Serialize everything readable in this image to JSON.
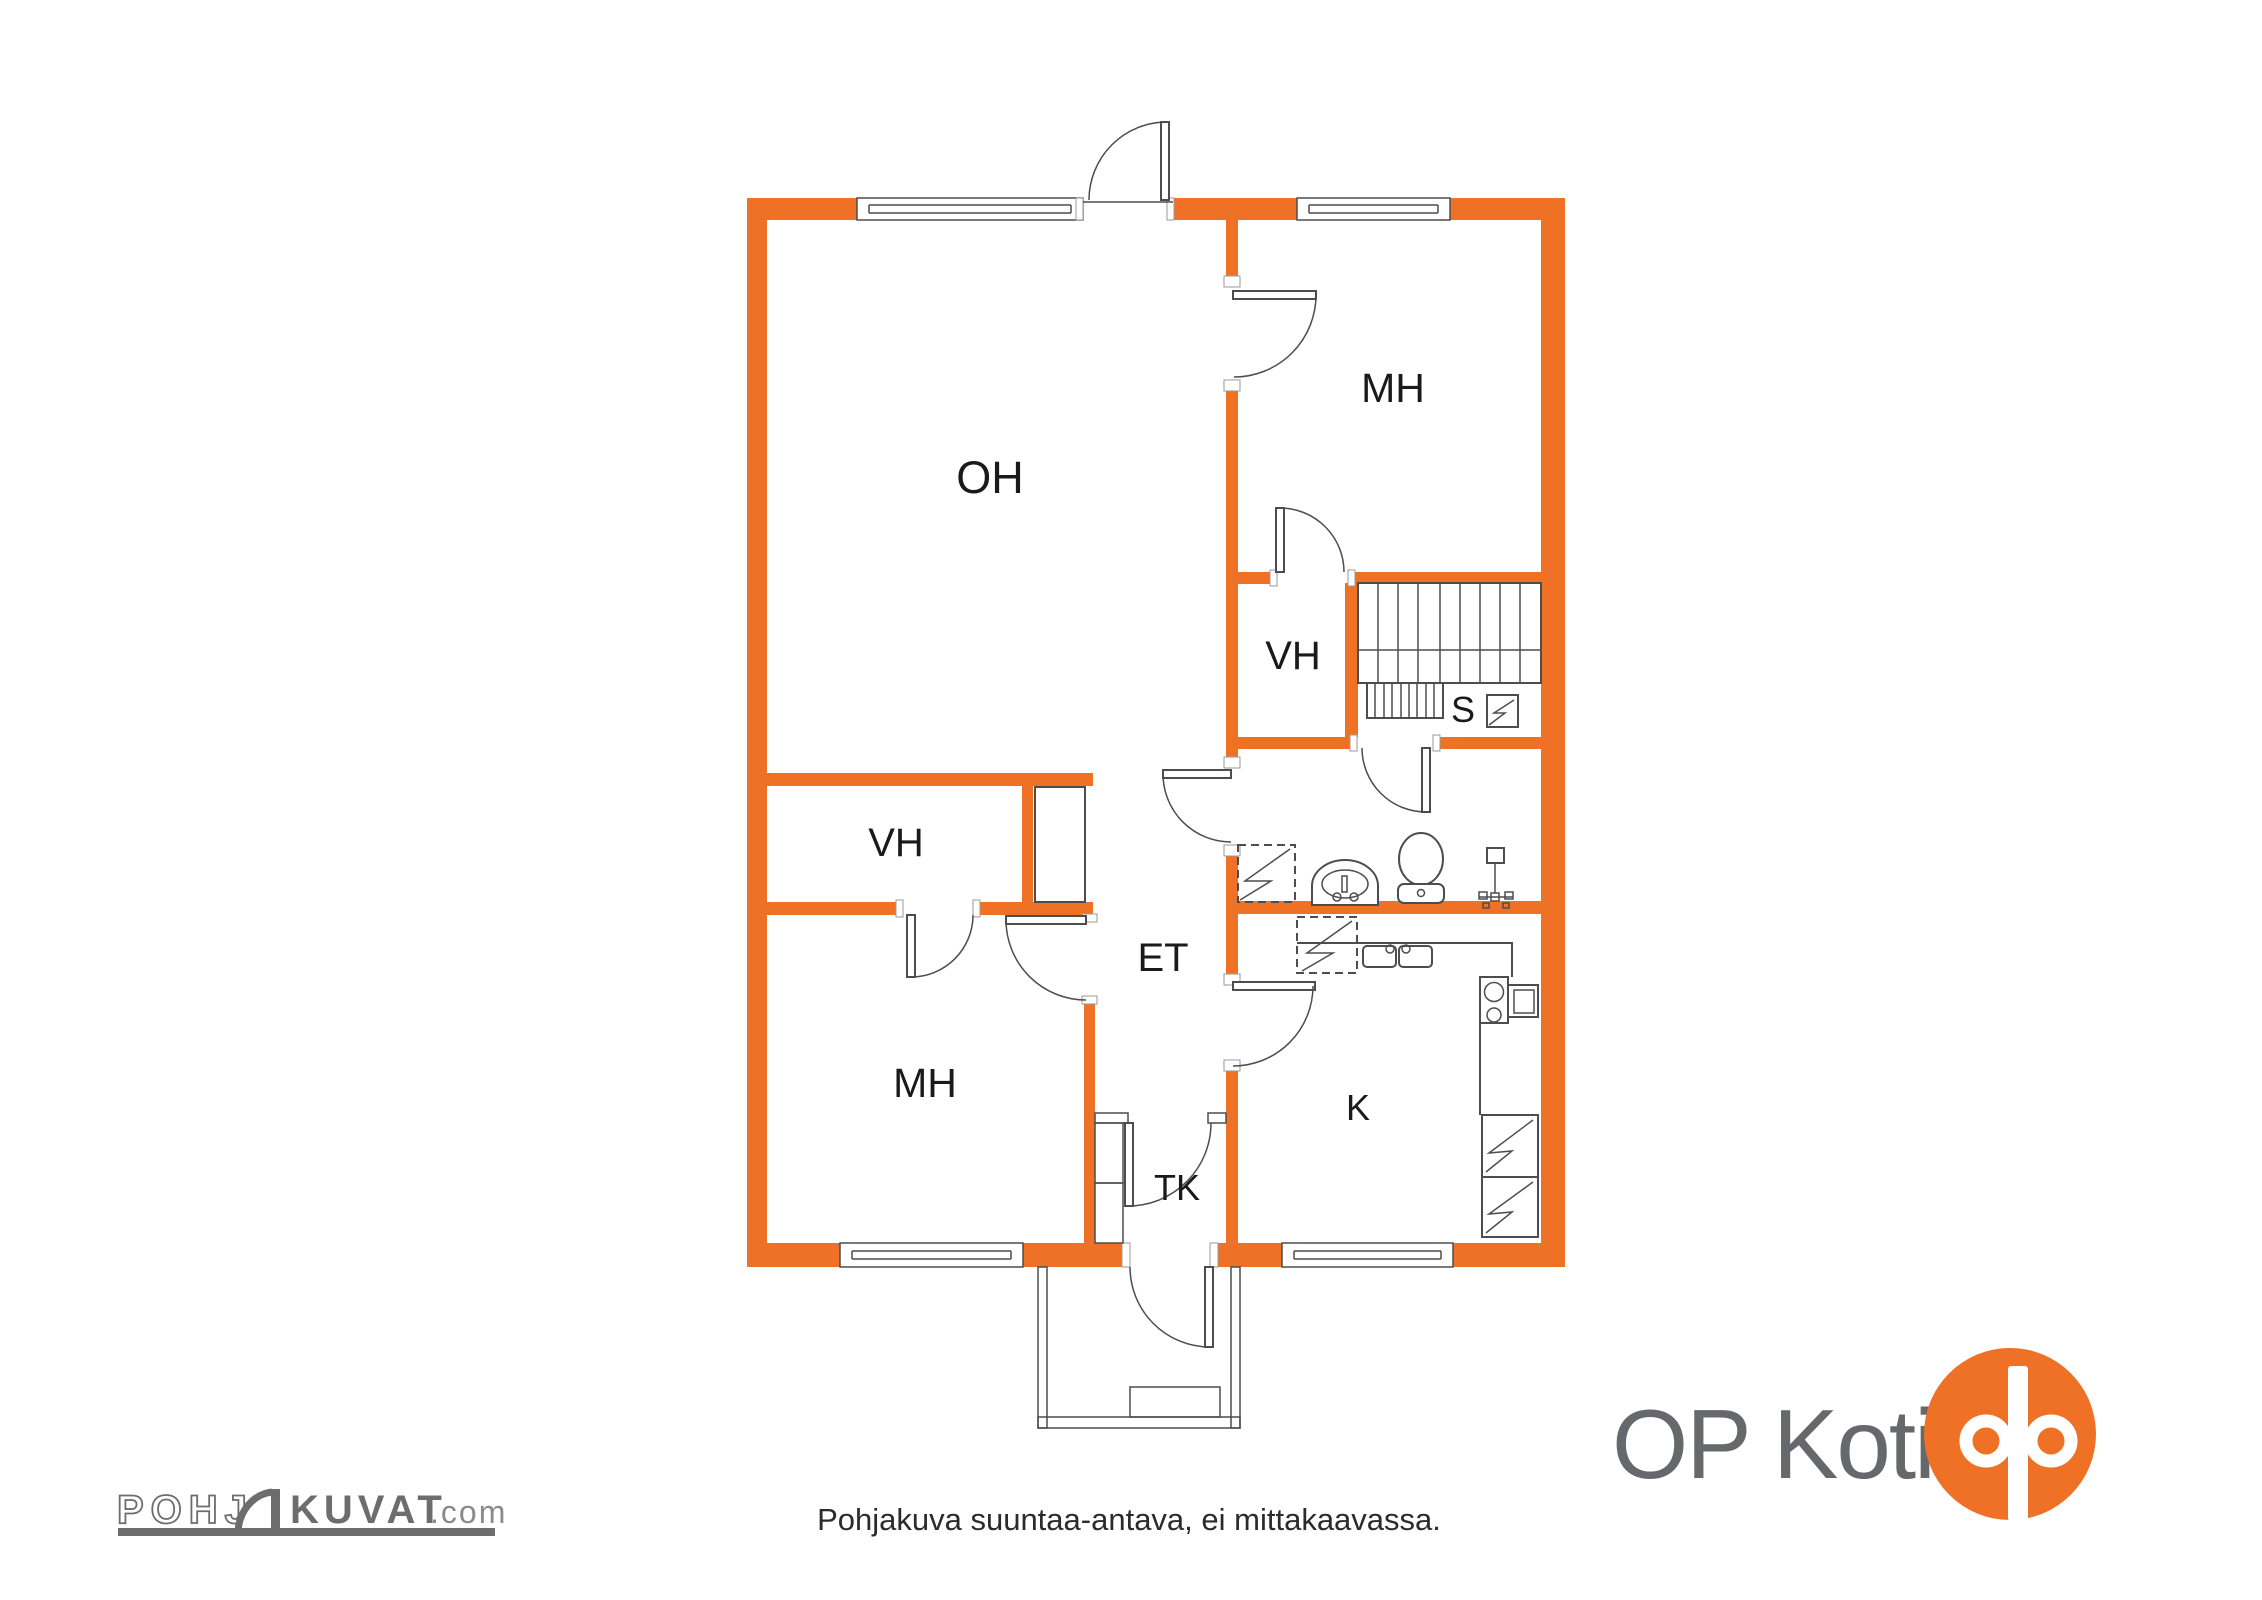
{
  "colors": {
    "wall": "#EE7125",
    "line": "#4D4D4F",
    "label": "#1A1A1A",
    "logogray": "#6D6D6D",
    "logograylight": "#8B8B8B",
    "optext": "#66686B",
    "disc": "#2B2B2B"
  },
  "labels": {
    "oh": "OH",
    "mh_top": "MH",
    "vh_right": "VH",
    "stairs_s": "S",
    "vh_left": "VH",
    "et": "ET",
    "mh_bottom": "MH",
    "tk": "TK",
    "k": "K"
  },
  "footer": {
    "disclaimer": "Pohjakuva suuntaa-antava, ei mittakaavassa."
  },
  "branding": {
    "pohjakuvat": {
      "part1": "POHJ",
      "part2": "KUVAT",
      "suffix": ".com"
    },
    "op_koti": "OP Koti"
  },
  "icons": {
    "stairs-icon": "staircase treads",
    "electrical-panel-icon": "square with lightning bolt",
    "water-heater-icon": "dashed square with bolt",
    "sink-icon": "washbasin",
    "toilet-icon": "WC",
    "shower-tap-icon": "tap with handles",
    "kitchen-sink-icon": "double basin",
    "stove-icon": "hob with burners",
    "fridge-icon": "box with bolt",
    "door-swing-icon": "quarter-circle door swing",
    "window-icon": "double line window",
    "op-logo-icon": "orange circle with white OP rings"
  }
}
